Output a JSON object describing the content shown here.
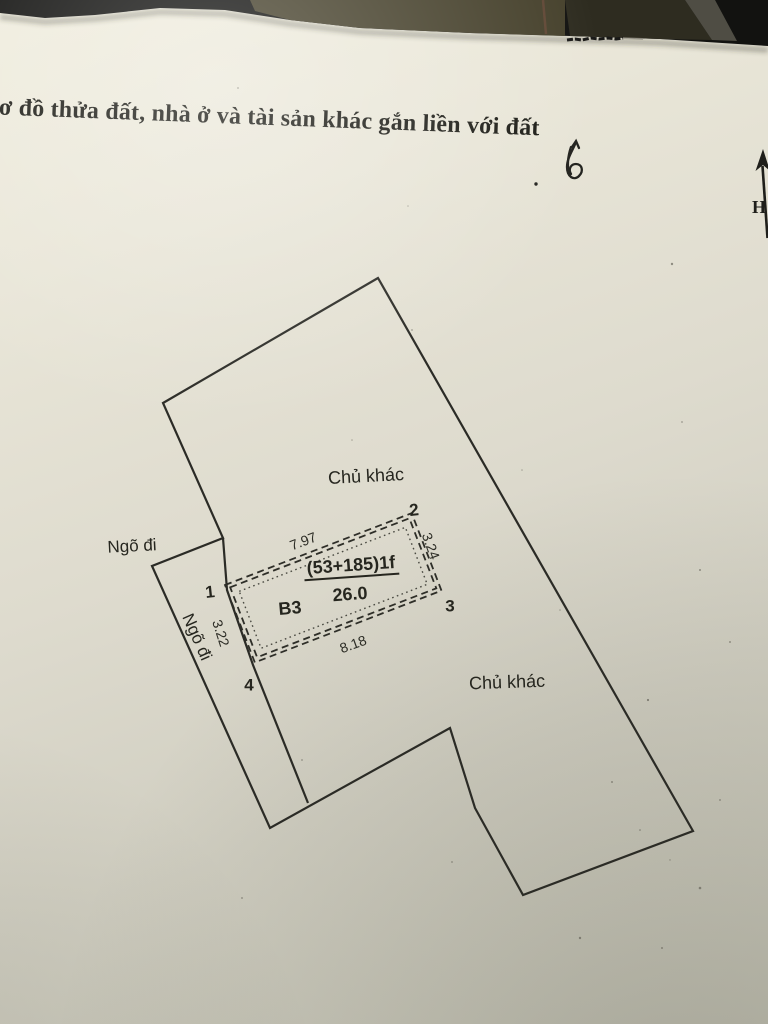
{
  "title": {
    "text": "Sơ đồ thửa đất, nhà ở và tài sản khác gắn liền với đất"
  },
  "diagram": {
    "neighbor_top": "Chủ khác",
    "neighbor_bottom": "Chủ khác",
    "alley_outer_label": "Ngõ đi",
    "alley_inner_label": "Ngõ đi",
    "north_arrow_letter": "H",
    "parcel": {
      "house_label": "(53+185)1f",
      "area": "26.0",
      "block_label": "B3",
      "dim_top": "7.97",
      "dim_right": "3.24",
      "dim_bottom": "8.18",
      "dim_left": "3.22",
      "corner_1": "1",
      "corner_2": "2",
      "corner_3": "3",
      "corner_4": "4"
    }
  },
  "photo": {
    "colors": {
      "paper_top": "#f0edde",
      "paper_bottom": "#c5c4b6",
      "ink": "#2b2b26",
      "backdrop_black": "#121210",
      "backdrop_olive": "#46412c"
    }
  }
}
